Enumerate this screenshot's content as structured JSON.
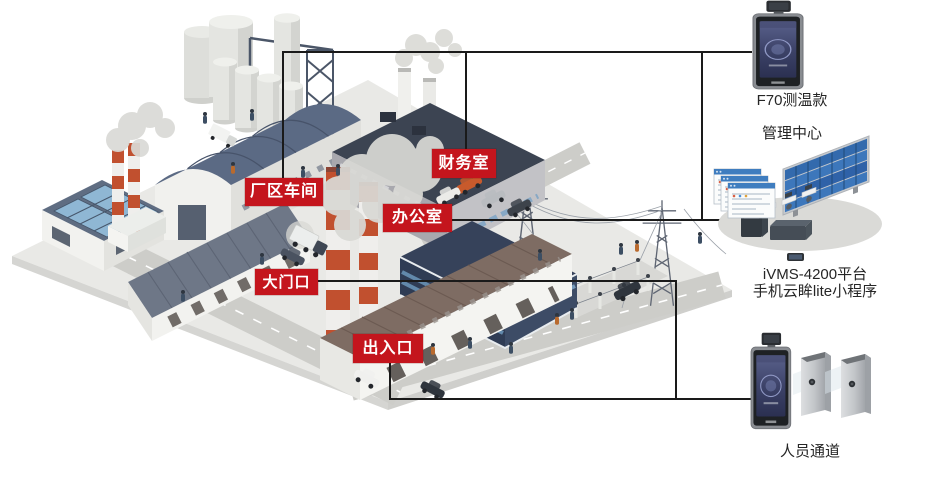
{
  "site_labels": {
    "workshop": "厂区车间",
    "finance": "财务室",
    "office": "办公室",
    "gate": "大门口",
    "exit": "出入口"
  },
  "captions": {
    "f70_model": "F70测温款",
    "management_center": "管理中心",
    "ivms_platform": "iVMS-4200平台",
    "mini_program": "手机云眸lite小程序",
    "personnel_channel": "人员通道"
  },
  "colors": {
    "label_background": "#c4151d",
    "label_text": "#ffffff",
    "connection_line": "#1a1a1a",
    "caption_text": "#262626",
    "chimney_red": "#c1502f",
    "screen_blue": "#33395c",
    "background": "#ffffff"
  }
}
